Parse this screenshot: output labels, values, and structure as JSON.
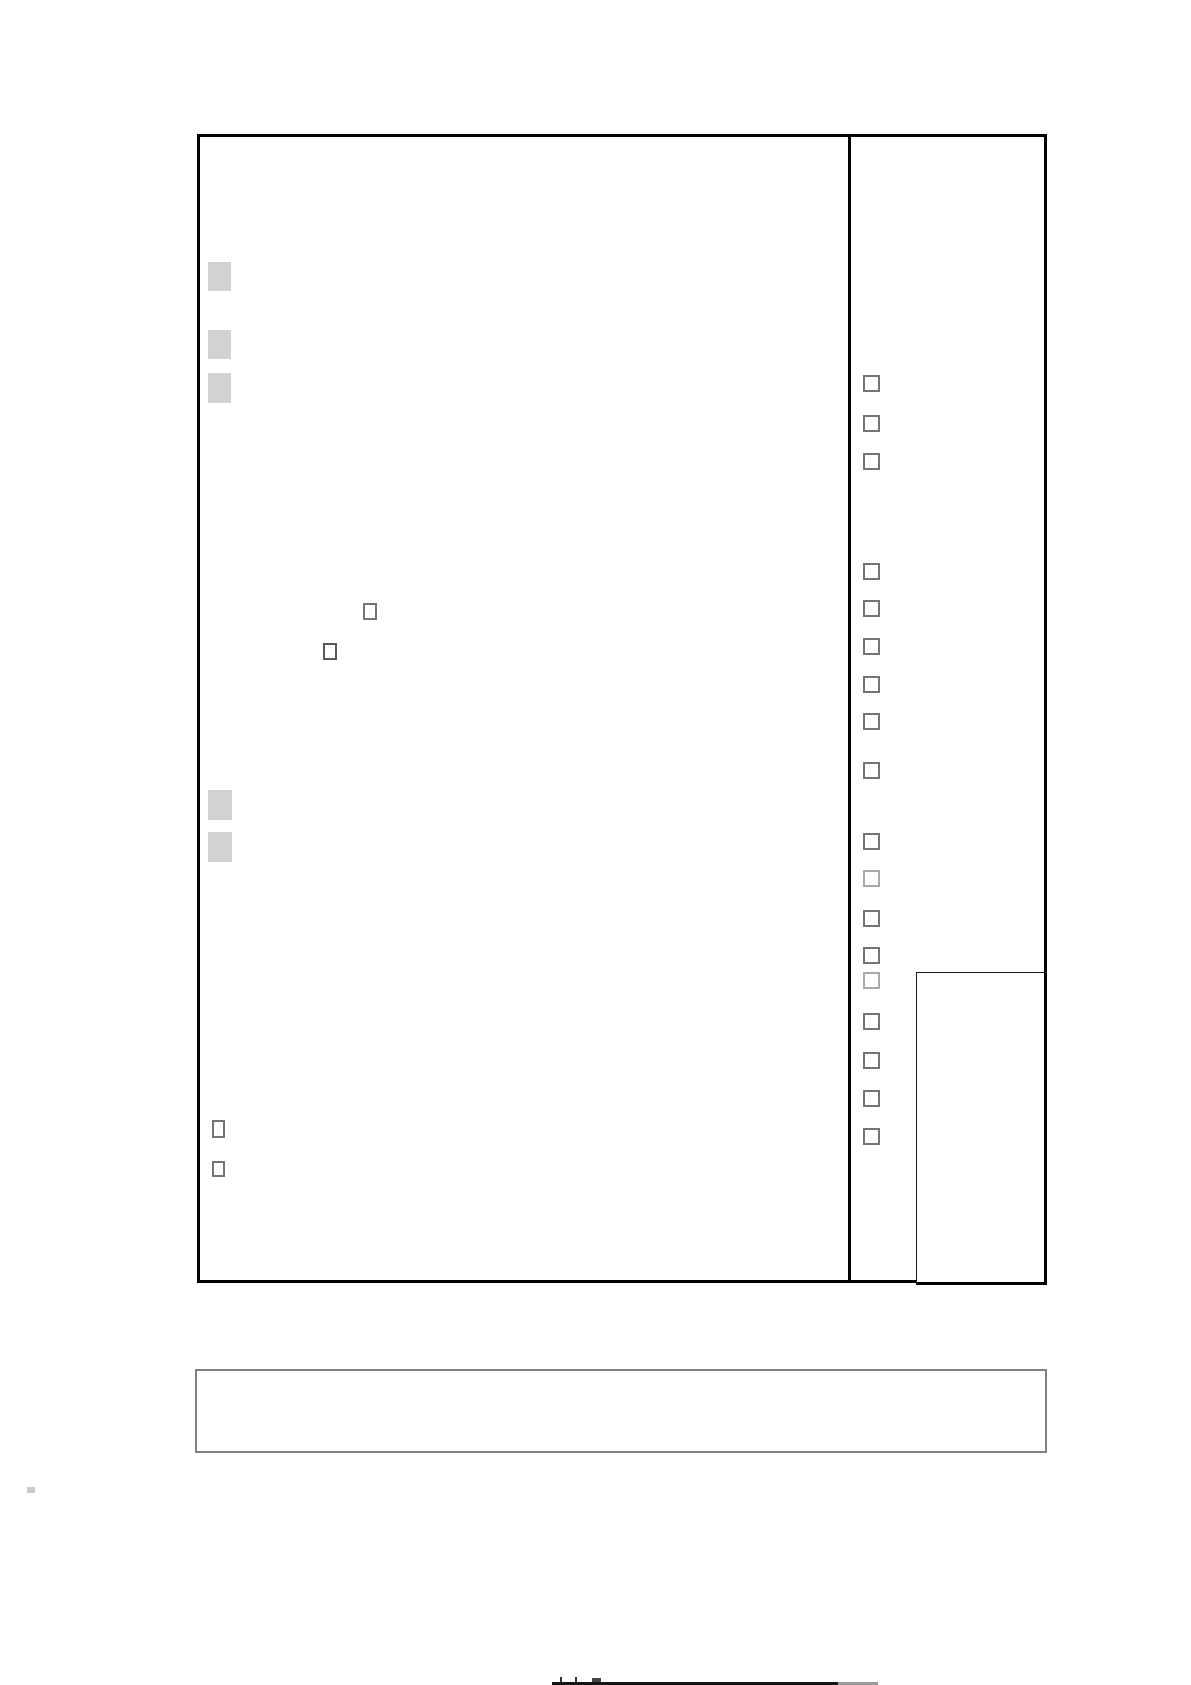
{
  "page": {
    "width": 1191,
    "height": 1685,
    "background": "#ffffff",
    "text_content": ""
  },
  "form_sheet": {
    "outer_box": {
      "left": 197,
      "top": 134,
      "width": 850,
      "height": 1149,
      "border_color": "#000000",
      "border_width": 3
    },
    "column_divider": {
      "x": 848,
      "y": 134,
      "w": 3,
      "h": 1149,
      "color": "#000000"
    },
    "nested_bottom_right_box": {
      "left": 916,
      "top": 972,
      "width": 131,
      "height": 313,
      "border_color": "#1a1a1a"
    },
    "bottom_note_box": {
      "left": 195,
      "top": 1369,
      "width": 852,
      "height": 84,
      "border_color": "#818181",
      "border_width": 2
    },
    "gray_square_color": "#d2d2d2",
    "gray_placeholder_squares": [
      {
        "x": 208,
        "y": 262,
        "w": 23,
        "h": 29
      },
      {
        "x": 208,
        "y": 330,
        "w": 23,
        "h": 29
      },
      {
        "x": 208,
        "y": 373,
        "w": 23,
        "h": 30
      },
      {
        "x": 208,
        "y": 790,
        "w": 24,
        "h": 30
      },
      {
        "x": 208,
        "y": 832,
        "w": 24,
        "h": 30
      }
    ],
    "checkbox_colors": {
      "normal": "#757575",
      "dark": "#585858",
      "light": "#a9a9a9"
    },
    "inline_checkboxes": [
      {
        "x": 363,
        "y": 603,
        "w": 14,
        "h": 17,
        "shade": "normal",
        "checked": false
      },
      {
        "x": 323,
        "y": 643,
        "w": 14,
        "h": 17,
        "shade": "dark",
        "checked": false
      }
    ],
    "footer_checkboxes": [
      {
        "x": 212,
        "y": 1120,
        "w": 13,
        "h": 18,
        "shade": "normal",
        "checked": false
      },
      {
        "x": 212,
        "y": 1161,
        "w": 13,
        "h": 16,
        "shade": "normal",
        "checked": false
      }
    ],
    "right_column_checkboxes": {
      "x": 863,
      "w": 17,
      "h": 17,
      "all_checked": false,
      "ys": [
        375,
        415,
        453,
        563,
        600,
        638,
        676,
        713,
        762,
        833,
        870,
        910,
        947,
        972,
        1013,
        1052,
        1090,
        1128
      ],
      "light_ys": [
        870,
        972
      ]
    },
    "page_edge_artifacts": [
      {
        "x": 552,
        "y": 1682,
        "w": 286,
        "h": 3,
        "color": "#141414"
      },
      {
        "x": 838,
        "y": 1682,
        "w": 40,
        "h": 3,
        "color": "#9a9a9a"
      },
      {
        "x": 560,
        "y": 1677,
        "w": 2,
        "h": 5,
        "color": "#333333"
      },
      {
        "x": 575,
        "y": 1677,
        "w": 2,
        "h": 5,
        "color": "#333333"
      },
      {
        "x": 592,
        "y": 1678,
        "w": 9,
        "h": 4,
        "color": "#444444"
      },
      {
        "x": 27,
        "y": 1487,
        "w": 8,
        "h": 6,
        "color": "#cccccc"
      }
    ]
  }
}
